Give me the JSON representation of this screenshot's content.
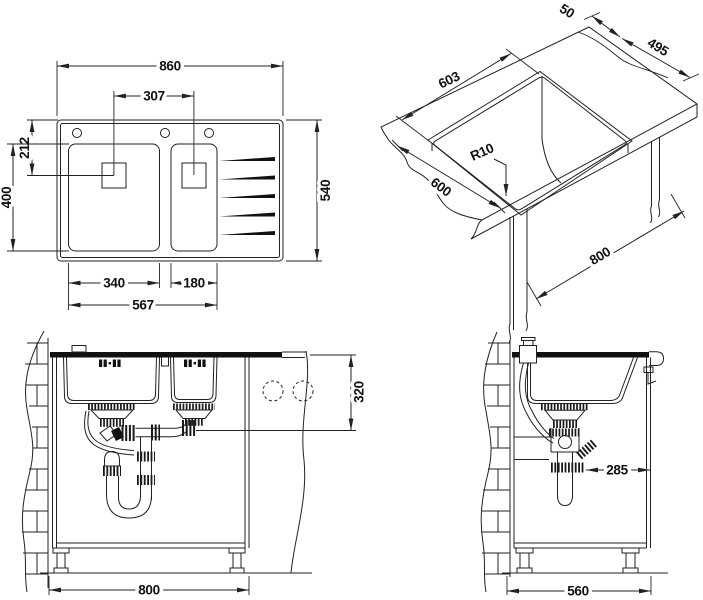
{
  "drawing": {
    "background": "#ffffff",
    "line_color": "#222222",
    "accent_fill": "#111111"
  },
  "views": {
    "plan": {
      "name": "top-view-double-bowl-sink",
      "dims": {
        "overall_width": "860",
        "drain_spacing": "307",
        "drain_offset": "212",
        "bowl_length": "400",
        "overall_depth": "540",
        "left_bowl_width": "340",
        "right_bowl_width": "180",
        "bowls_outer_width": "567"
      }
    },
    "iso": {
      "name": "worktop-cutout-isometric-view",
      "dims": {
        "rim_width": "50",
        "cutout_width": "495",
        "cutout_length": "603",
        "counter_depth": "600",
        "corner_radius": "R10",
        "cabinet_width": "800"
      }
    },
    "front": {
      "name": "front-installation-view",
      "dims": {
        "drain_height": "320",
        "cabinet_width": "800"
      }
    },
    "side": {
      "name": "side-installation-view",
      "dims": {
        "drain_wall_offset": "285",
        "cabinet_depth": "560"
      }
    }
  }
}
